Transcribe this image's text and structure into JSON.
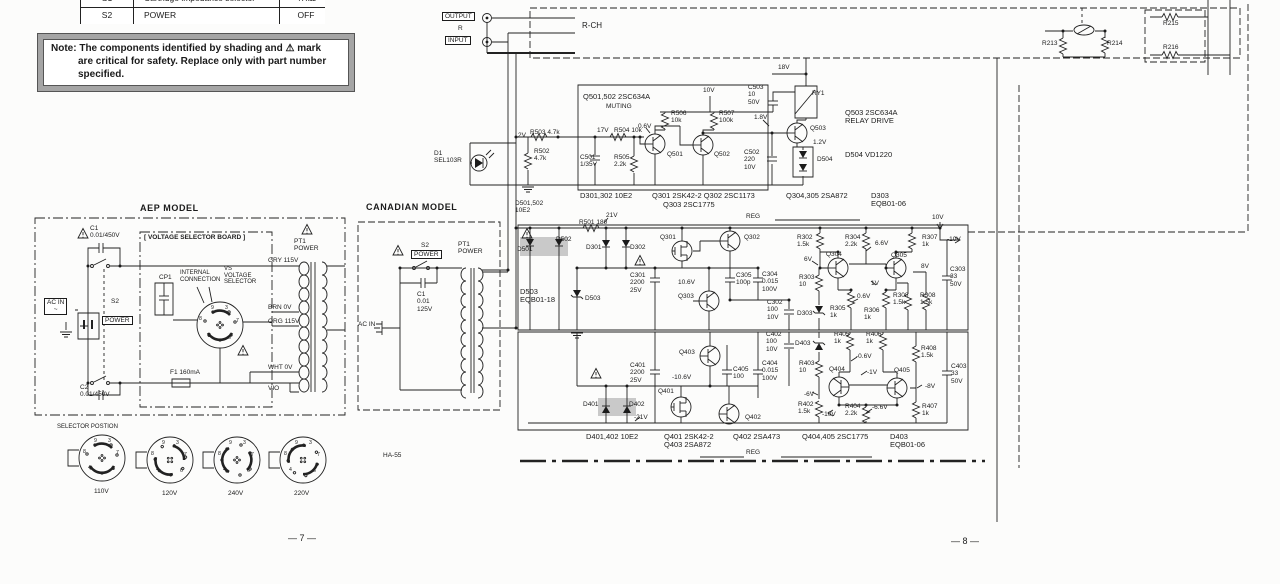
{
  "page": {
    "left": "— 7 —",
    "right": "— 8 —"
  },
  "switch_table": {
    "rows": [
      [
        "S1",
        "Cartridge impedance selector",
        "47kΩ"
      ],
      [
        "S2",
        "POWER",
        "OFF"
      ]
    ]
  },
  "note": {
    "lines": [
      "Note: The components identified by shading and ⚠ mark",
      "are critical for safety.  Replace only with part number",
      "specified."
    ]
  },
  "colors": {
    "ink": "#1b1b1b",
    "shade": "#c9c9c9",
    "paper": "#fcfcfb"
  },
  "labels": [
    {
      "n": "output-label",
      "t": "OUTPUT",
      "x": 442,
      "y": 12,
      "c": "b"
    },
    {
      "n": "input-label",
      "t": "INPUT",
      "x": 445,
      "y": 36,
      "c": "b"
    },
    {
      "n": "io-r-label",
      "t": "R",
      "x": 458,
      "y": 25
    },
    {
      "n": "rch-label",
      "t": "R-CH",
      "x": 582,
      "y": 22,
      "c": "t8"
    },
    {
      "n": "r213-label",
      "t": "R213",
      "x": 1042,
      "y": 40
    },
    {
      "n": "r214-label",
      "t": "R214",
      "x": 1107,
      "y": 40
    },
    {
      "n": "r215-label",
      "t": "R215",
      "x": 1163,
      "y": 20
    },
    {
      "n": "r216-label",
      "t": "R216",
      "x": 1163,
      "y": 44
    },
    {
      "n": "q501-502-type",
      "t": "Q501,502 2SC634A",
      "x": 583,
      "y": 93,
      "c": "t75"
    },
    {
      "n": "muting-label",
      "t": "MUTING",
      "x": 606,
      "y": 103
    },
    {
      "n": "v-10v-muting",
      "t": "10V",
      "x": 703,
      "y": 87
    },
    {
      "n": "r506-label",
      "t": "R506\n10k",
      "x": 671,
      "y": 110
    },
    {
      "n": "r507-label",
      "t": "R507\n100k",
      "x": 719,
      "y": 110
    },
    {
      "n": "c503-label",
      "t": "C503\n10\n50V",
      "x": 748,
      "y": 84
    },
    {
      "n": "ry1-label",
      "t": "RY1",
      "x": 812,
      "y": 90
    },
    {
      "n": "v-18v",
      "t": "18V",
      "x": 778,
      "y": 64
    },
    {
      "n": "v-0p6-q501",
      "t": "0.6V",
      "x": 638,
      "y": 123
    },
    {
      "n": "v-1p8",
      "t": "1.8V",
      "x": 754,
      "y": 114
    },
    {
      "n": "v-2v",
      "t": "2V",
      "x": 518,
      "y": 132
    },
    {
      "n": "r503-label",
      "t": "R503 4.7k",
      "x": 530,
      "y": 129
    },
    {
      "n": "v-17v",
      "t": "17V",
      "x": 597,
      "y": 127
    },
    {
      "n": "r504-label",
      "t": "R504 10k",
      "x": 614,
      "y": 127
    },
    {
      "n": "r502-label",
      "t": "R502\n4.7k",
      "x": 534,
      "y": 148
    },
    {
      "n": "c501-label",
      "t": "C501\n1/35V",
      "x": 580,
      "y": 154
    },
    {
      "n": "r505-label",
      "t": "R505\n2.2k",
      "x": 614,
      "y": 154
    },
    {
      "n": "q501-label",
      "t": "Q501",
      "x": 667,
      "y": 151
    },
    {
      "n": "q502-label",
      "t": "Q502",
      "x": 714,
      "y": 151
    },
    {
      "n": "c502-label",
      "t": "C502\n220\n10V",
      "x": 744,
      "y": 149
    },
    {
      "n": "q503-label",
      "t": "Q503",
      "x": 810,
      "y": 125
    },
    {
      "n": "v-1p2",
      "t": "1.2V",
      "x": 813,
      "y": 139
    },
    {
      "n": "d504-label",
      "t": "D504",
      "x": 817,
      "y": 156
    },
    {
      "n": "d1-label",
      "t": "D1\nSEL103R",
      "x": 434,
      "y": 150
    },
    {
      "n": "q503-type",
      "t": "Q503 2SC634A\nRELAY DRIVE",
      "x": 845,
      "y": 109,
      "c": "t75"
    },
    {
      "n": "d504-type",
      "t": "D504 VD1220",
      "x": 845,
      "y": 151,
      "c": "t75"
    },
    {
      "n": "d501-502-type",
      "t": "D501,502\n10E2",
      "x": 515,
      "y": 200
    },
    {
      "n": "d301-302-type",
      "t": "D301,302 10E2",
      "x": 580,
      "y": 192,
      "c": "t75"
    },
    {
      "n": "q301-302-type",
      "t": "Q301 2SK42-2  Q302 2SC1173",
      "x": 652,
      "y": 192,
      "c": "t75"
    },
    {
      "n": "q303-type",
      "t": "Q303 2SC1775",
      "x": 663,
      "y": 201,
      "c": "t75"
    },
    {
      "n": "reg-top-label",
      "t": "REG",
      "x": 746,
      "y": 213
    },
    {
      "n": "q304-305-type",
      "t": "Q304,305 2SA872",
      "x": 786,
      "y": 192,
      "c": "t75"
    },
    {
      "n": "d303-type",
      "t": "D303\nEQB01-06",
      "x": 871,
      "y": 192,
      "c": "t75"
    },
    {
      "n": "r501-label",
      "t": "R501 180",
      "x": 579,
      "y": 219
    },
    {
      "n": "v-21v",
      "t": "21V",
      "x": 606,
      "y": 212
    },
    {
      "n": "v-10v-out",
      "t": "10V",
      "x": 932,
      "y": 214
    },
    {
      "n": "d501-label",
      "t": "D501",
      "x": 517,
      "y": 246
    },
    {
      "n": "d502-label",
      "t": "D502",
      "x": 556,
      "y": 236
    },
    {
      "n": "d301-label",
      "t": "D301",
      "x": 586,
      "y": 244
    },
    {
      "n": "d302-label",
      "t": "D302",
      "x": 630,
      "y": 244
    },
    {
      "n": "q301-label",
      "t": "Q301",
      "x": 660,
      "y": 234
    },
    {
      "n": "c301-label",
      "t": "C301\n2200\n25V",
      "x": 630,
      "y": 272
    },
    {
      "n": "d503-type",
      "t": "D503\nEQB01-18",
      "x": 520,
      "y": 288,
      "c": "t75"
    },
    {
      "n": "d503-label",
      "t": "D503",
      "x": 585,
      "y": 295
    },
    {
      "n": "v-10p6",
      "t": "10.6V",
      "x": 678,
      "y": 279
    },
    {
      "n": "q303-label",
      "t": "Q303",
      "x": 678,
      "y": 293
    },
    {
      "n": "c305-label",
      "t": "C305\n100p",
      "x": 736,
      "y": 272
    },
    {
      "n": "q302-label",
      "t": "Q302",
      "x": 744,
      "y": 234
    },
    {
      "n": "r302-label",
      "t": "R302\n1.5k",
      "x": 797,
      "y": 234
    },
    {
      "n": "r304-label",
      "t": "R304\n2.2k",
      "x": 845,
      "y": 234
    },
    {
      "n": "v-6p6",
      "t": "6.6V",
      "x": 875,
      "y": 240
    },
    {
      "n": "r307-label",
      "t": "R307\n1k",
      "x": 922,
      "y": 234
    },
    {
      "n": "v-m10-top",
      "t": "-10V",
      "x": 947,
      "y": 236
    },
    {
      "n": "q304-label",
      "t": "Q304",
      "x": 826,
      "y": 251
    },
    {
      "n": "q305-label",
      "t": "Q305",
      "x": 891,
      "y": 252
    },
    {
      "n": "v-6v",
      "t": "6V",
      "x": 804,
      "y": 256
    },
    {
      "n": "v-8v",
      "t": "8V",
      "x": 921,
      "y": 263
    },
    {
      "n": "c304-label",
      "t": "C304\n0.015\n100V",
      "x": 762,
      "y": 271
    },
    {
      "n": "r303-label",
      "t": "R303\n10",
      "x": 799,
      "y": 274
    },
    {
      "n": "v-1v",
      "t": "1V",
      "x": 871,
      "y": 280
    },
    {
      "n": "v-0p6-reg",
      "t": "0.6V",
      "x": 857,
      "y": 293
    },
    {
      "n": "c302-label",
      "t": "C302\n100\n10V",
      "x": 767,
      "y": 299
    },
    {
      "n": "d303-label",
      "t": "D303",
      "x": 797,
      "y": 310
    },
    {
      "n": "r305-label",
      "t": "R305\n1k",
      "x": 830,
      "y": 305
    },
    {
      "n": "r306-label",
      "t": "R306\n1k",
      "x": 864,
      "y": 307
    },
    {
      "n": "r308a-label",
      "t": "R308\n1.5k",
      "x": 893,
      "y": 292
    },
    {
      "n": "r308b-label",
      "t": "R308\n1.5k",
      "x": 920,
      "y": 292
    },
    {
      "n": "c303-label",
      "t": "C303\n33\n50V",
      "x": 950,
      "y": 266
    },
    {
      "n": "q403-label",
      "t": "Q403",
      "x": 679,
      "y": 349
    },
    {
      "n": "c402-label",
      "t": "C402\n100\n10V",
      "x": 766,
      "y": 331
    },
    {
      "n": "d403-label",
      "t": "D403",
      "x": 795,
      "y": 340
    },
    {
      "n": "c401-label",
      "t": "C401\n2200\n25V",
      "x": 630,
      "y": 362
    },
    {
      "n": "v-m10p6",
      "t": "-10.6V",
      "x": 672,
      "y": 374
    },
    {
      "n": "c405-label",
      "t": "C405\n100",
      "x": 733,
      "y": 366
    },
    {
      "n": "c404-label",
      "t": "C404\n0.015\n100V",
      "x": 762,
      "y": 360
    },
    {
      "n": "r403-label",
      "t": "R403\n10",
      "x": 799,
      "y": 360
    },
    {
      "n": "v-m6",
      "t": "-6V",
      "x": 804,
      "y": 391
    },
    {
      "n": "r402-label",
      "t": "R402\n1.5k",
      "x": 798,
      "y": 401
    },
    {
      "n": "q401-label",
      "t": "Q401",
      "x": 658,
      "y": 388
    },
    {
      "n": "d401-label",
      "t": "D401",
      "x": 583,
      "y": 401
    },
    {
      "n": "d402-label",
      "t": "D402",
      "x": 629,
      "y": 401
    },
    {
      "n": "v-m21",
      "t": "-21V",
      "x": 634,
      "y": 414
    },
    {
      "n": "q402-label",
      "t": "Q402",
      "x": 745,
      "y": 414
    },
    {
      "n": "r405-label",
      "t": "R405\n1k",
      "x": 834,
      "y": 331
    },
    {
      "n": "r406-label",
      "t": "R406\n1k",
      "x": 866,
      "y": 331
    },
    {
      "n": "v-m0p6",
      "t": "-0.6V",
      "x": 856,
      "y": 353
    },
    {
      "n": "r408-label",
      "t": "R408\n1.5k",
      "x": 921,
      "y": 345
    },
    {
      "n": "q404-label",
      "t": "Q404",
      "x": 829,
      "y": 366
    },
    {
      "n": "q405-label",
      "t": "Q405",
      "x": 894,
      "y": 367
    },
    {
      "n": "v-m1",
      "t": "-1V",
      "x": 867,
      "y": 369
    },
    {
      "n": "v-m8",
      "t": "-8V",
      "x": 925,
      "y": 383
    },
    {
      "n": "r404-label",
      "t": "R404\n2.2k",
      "x": 845,
      "y": 403
    },
    {
      "n": "v-m6p6",
      "t": "-6.6V",
      "x": 872,
      "y": 404
    },
    {
      "n": "r407-label",
      "t": "R407\n1k",
      "x": 922,
      "y": 403
    },
    {
      "n": "c403-label",
      "t": "C403\n33\n50V",
      "x": 951,
      "y": 363
    },
    {
      "n": "v-m10-bot",
      "t": "-10V",
      "x": 822,
      "y": 411
    },
    {
      "n": "d401-402-type",
      "t": "D401,402 10E2",
      "x": 586,
      "y": 433,
      "c": "t75"
    },
    {
      "n": "q401-403-type",
      "t": "Q401 2SK42-2\nQ403 2SA872",
      "x": 664,
      "y": 433,
      "c": "t75"
    },
    {
      "n": "q402-type",
      "t": "Q402 2SA473",
      "x": 733,
      "y": 433,
      "c": "t75"
    },
    {
      "n": "q404-405-type",
      "t": "Q404,405 2SC1775",
      "x": 802,
      "y": 433,
      "c": "t75"
    },
    {
      "n": "d403-type",
      "t": "D403\nEQB01-06",
      "x": 890,
      "y": 433,
      "c": "t75"
    },
    {
      "n": "reg-bottom-label",
      "t": "REG",
      "x": 746,
      "y": 449
    },
    {
      "n": "aep-model-title",
      "t": "AEP MODEL",
      "x": 140,
      "y": 203,
      "c": "t9"
    },
    {
      "n": "c1-aep-label",
      "t": "C1\n0.01/450V",
      "x": 90,
      "y": 225
    },
    {
      "n": "vsb-title",
      "t": "[ VOLTAGE SELECTOR BOARD ]",
      "x": 144,
      "y": 234,
      "c": "bd"
    },
    {
      "n": "pt1-aep-label",
      "t": "PT1\nPOWER",
      "x": 294,
      "y": 238
    },
    {
      "n": "cp1-label",
      "t": "CP1",
      "x": 159,
      "y": 274
    },
    {
      "n": "internal-connection-label",
      "t": "INTERNAL\nCONNECTION",
      "x": 180,
      "y": 270,
      "c": "t6"
    },
    {
      "n": "vs-selector-label",
      "t": "VS\nVOLTAGE\nSELECTOR",
      "x": 224,
      "y": 266,
      "c": "t6"
    },
    {
      "n": "s2-aep-label",
      "t": "S2",
      "x": 111,
      "y": 298
    },
    {
      "n": "power-aep-label",
      "t": "POWER",
      "x": 102,
      "y": 316,
      "c": "b"
    },
    {
      "n": "acin-aep-label",
      "t": "AC IN\n~",
      "x": 44,
      "y": 298,
      "c": "b"
    },
    {
      "n": "f1-label",
      "t": "F1 160mA",
      "x": 170,
      "y": 369
    },
    {
      "n": "c2-aep-label",
      "t": "C2\n0.01/450V",
      "x": 80,
      "y": 384
    },
    {
      "n": "tap-gry",
      "t": "GRY  115V",
      "x": 268,
      "y": 257
    },
    {
      "n": "tap-brn",
      "t": "BRN  0V",
      "x": 268,
      "y": 304
    },
    {
      "n": "tap-org",
      "t": "ORG  115V",
      "x": 268,
      "y": 318
    },
    {
      "n": "tap-wht",
      "t": "WHT  0V",
      "x": 268,
      "y": 364
    },
    {
      "n": "tap-vio",
      "t": "VIO",
      "x": 268,
      "y": 385
    },
    {
      "n": "selector-position-title",
      "t": "SELECTOR POSTION",
      "x": 57,
      "y": 424,
      "c": "t6"
    },
    {
      "n": "dial-110v-label",
      "t": "110V",
      "x": 94,
      "y": 488
    },
    {
      "n": "dial-120v-label",
      "t": "120V",
      "x": 162,
      "y": 490
    },
    {
      "n": "dial-240v-label",
      "t": "240V",
      "x": 228,
      "y": 490
    },
    {
      "n": "dial-220v-label",
      "t": "220V",
      "x": 294,
      "y": 490
    },
    {
      "n": "canadian-model-title",
      "t": "CANADIAN MODEL",
      "x": 366,
      "y": 202,
      "c": "t9"
    },
    {
      "n": "s2-can-label",
      "t": "S2",
      "x": 421,
      "y": 242
    },
    {
      "n": "power-can-label",
      "t": "POWER",
      "x": 411,
      "y": 250,
      "c": "b"
    },
    {
      "n": "c1-can-label",
      "t": "C1\n0.01\n125V",
      "x": 417,
      "y": 291
    },
    {
      "n": "acin-can-label",
      "t": "AC IN",
      "x": 358,
      "y": 321
    },
    {
      "n": "pt1-can-label",
      "t": "PT1\nPOWER",
      "x": 458,
      "y": 241
    },
    {
      "n": "ha55-label",
      "t": "HA-55",
      "x": 383,
      "y": 452
    },
    {
      "n": "vs-digit-9",
      "t": "9",
      "x": 211,
      "y": 306,
      "c": "t55"
    },
    {
      "n": "vs-digit-3",
      "t": "3",
      "x": 225,
      "y": 306,
      "c": "t55"
    },
    {
      "n": "vs-digit-8",
      "t": "8",
      "x": 199,
      "y": 317,
      "c": "t55"
    },
    {
      "n": "vs-digit-7",
      "t": "7",
      "x": 236,
      "y": 319,
      "c": "t55"
    },
    {
      "n": "vs-digit-2",
      "t": "2",
      "x": 208,
      "y": 334,
      "c": "t55"
    },
    {
      "n": "vs-digit-6",
      "t": "6",
      "x": 228,
      "y": 336,
      "c": "t55"
    },
    {
      "n": "d110-digit-9",
      "t": "9",
      "x": 94,
      "y": 439,
      "c": "t55"
    },
    {
      "n": "d110-digit-3",
      "t": "3",
      "x": 108,
      "y": 439,
      "c": "t55"
    },
    {
      "n": "d110-digit-8",
      "t": "8",
      "x": 83,
      "y": 450,
      "c": "t55"
    },
    {
      "n": "d110-digit-7",
      "t": "7",
      "x": 116,
      "y": 451,
      "c": "t55"
    },
    {
      "n": "d110-digit-4",
      "t": "4",
      "x": 88,
      "y": 466,
      "c": "t55"
    },
    {
      "n": "d110-digit-6",
      "t": "6",
      "x": 112,
      "y": 467,
      "c": "t55"
    },
    {
      "n": "d120-digit-9",
      "t": "9",
      "x": 162,
      "y": 441,
      "c": "t55"
    },
    {
      "n": "d120-digit-3",
      "t": "3",
      "x": 176,
      "y": 441,
      "c": "t55"
    },
    {
      "n": "d120-digit-8",
      "t": "8",
      "x": 151,
      "y": 452,
      "c": "t55"
    },
    {
      "n": "d120-digit-7",
      "t": "7",
      "x": 184,
      "y": 453,
      "c": "t55"
    },
    {
      "n": "d120-digit-4",
      "t": "4",
      "x": 156,
      "y": 468,
      "c": "t55"
    },
    {
      "n": "d120-digit-6",
      "t": "6",
      "x": 180,
      "y": 469,
      "c": "t55"
    },
    {
      "n": "d240-digit-9",
      "t": "9",
      "x": 229,
      "y": 441,
      "c": "t55"
    },
    {
      "n": "d240-digit-3",
      "t": "3",
      "x": 243,
      "y": 441,
      "c": "t55"
    },
    {
      "n": "d240-digit-8",
      "t": "8",
      "x": 218,
      "y": 452,
      "c": "t55"
    },
    {
      "n": "d240-digit-7",
      "t": "7",
      "x": 251,
      "y": 453,
      "c": "t55"
    },
    {
      "n": "d240-digit-4",
      "t": "4",
      "x": 223,
      "y": 468,
      "c": "t55"
    },
    {
      "n": "d240-digit-6",
      "t": "6",
      "x": 247,
      "y": 469,
      "c": "t55"
    },
    {
      "n": "d220-digit-9",
      "t": "9",
      "x": 295,
      "y": 441,
      "c": "t55"
    },
    {
      "n": "d220-digit-3",
      "t": "3",
      "x": 309,
      "y": 441,
      "c": "t55"
    },
    {
      "n": "d220-digit-8",
      "t": "8",
      "x": 284,
      "y": 452,
      "c": "t55"
    },
    {
      "n": "d220-digit-7",
      "t": "7",
      "x": 317,
      "y": 453,
      "c": "t55"
    },
    {
      "n": "d220-digit-4",
      "t": "4",
      "x": 289,
      "y": 468,
      "c": "t55"
    },
    {
      "n": "d220-digit-6",
      "t": "6",
      "x": 313,
      "y": 469,
      "c": "t55"
    }
  ]
}
